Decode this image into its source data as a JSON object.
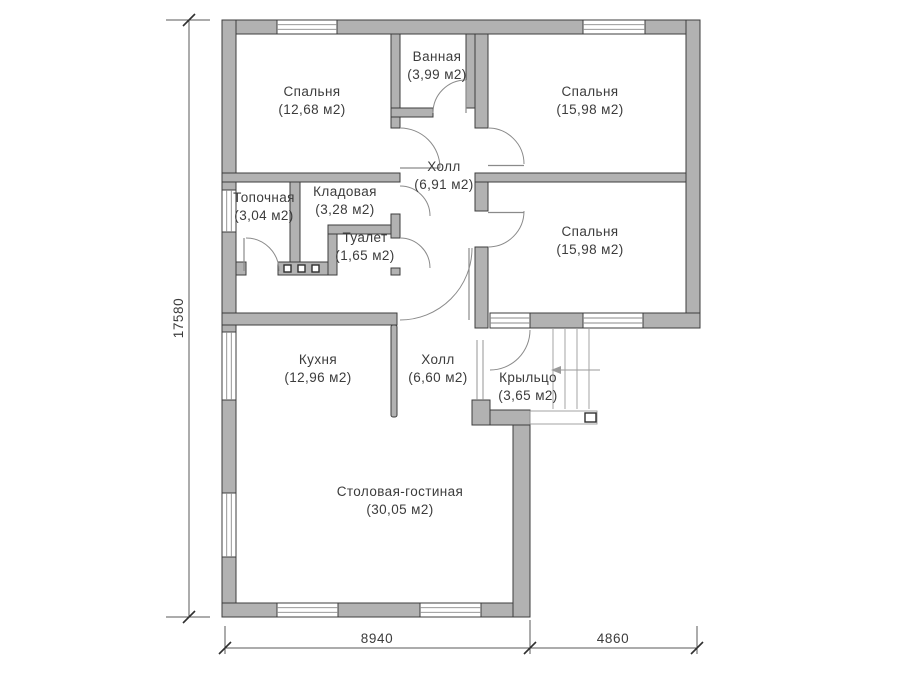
{
  "plan": {
    "type": "floor-plan",
    "language": "ru"
  },
  "rooms": [
    {
      "id": "bedroom-top-left",
      "name": "Спальня",
      "area": "(12,68 м2)"
    },
    {
      "id": "bathroom",
      "name": "Ванная",
      "area": "(3,99 м2)"
    },
    {
      "id": "bedroom-top-right",
      "name": "Спальня",
      "area": "(15,98 м2)"
    },
    {
      "id": "hall-upper",
      "name": "Холл",
      "area": "(6,91 м2)"
    },
    {
      "id": "boiler-room",
      "name": "Топочная",
      "area": "(3,04 м2)"
    },
    {
      "id": "storage",
      "name": "Кладовая",
      "area": "(3,28 м2)"
    },
    {
      "id": "toilet",
      "name": "Туалет",
      "area": "(1,65 м2)"
    },
    {
      "id": "bedroom-mid-right",
      "name": "Спальня",
      "area": "(15,98 м2)"
    },
    {
      "id": "kitchen",
      "name": "Кухня",
      "area": "(12,96 м2)"
    },
    {
      "id": "hall-lower",
      "name": "Холл",
      "area": "(6,60 м2)"
    },
    {
      "id": "porch",
      "name": "Крыльцо",
      "area": "(3,65 м2)"
    },
    {
      "id": "dining-living",
      "name": "Столовая-гостиная",
      "area": "(30,05 м2)"
    }
  ],
  "dimensions": {
    "left_height": "17580",
    "bottom_main_width": "8940",
    "bottom_porch_width": "4860"
  },
  "colors": {
    "wall_fill": "#b2b2b2",
    "wall_outline": "#3d3d3d",
    "text": "#3c3c3c",
    "thin_line": "#8a8a8a",
    "background": "#ffffff"
  }
}
